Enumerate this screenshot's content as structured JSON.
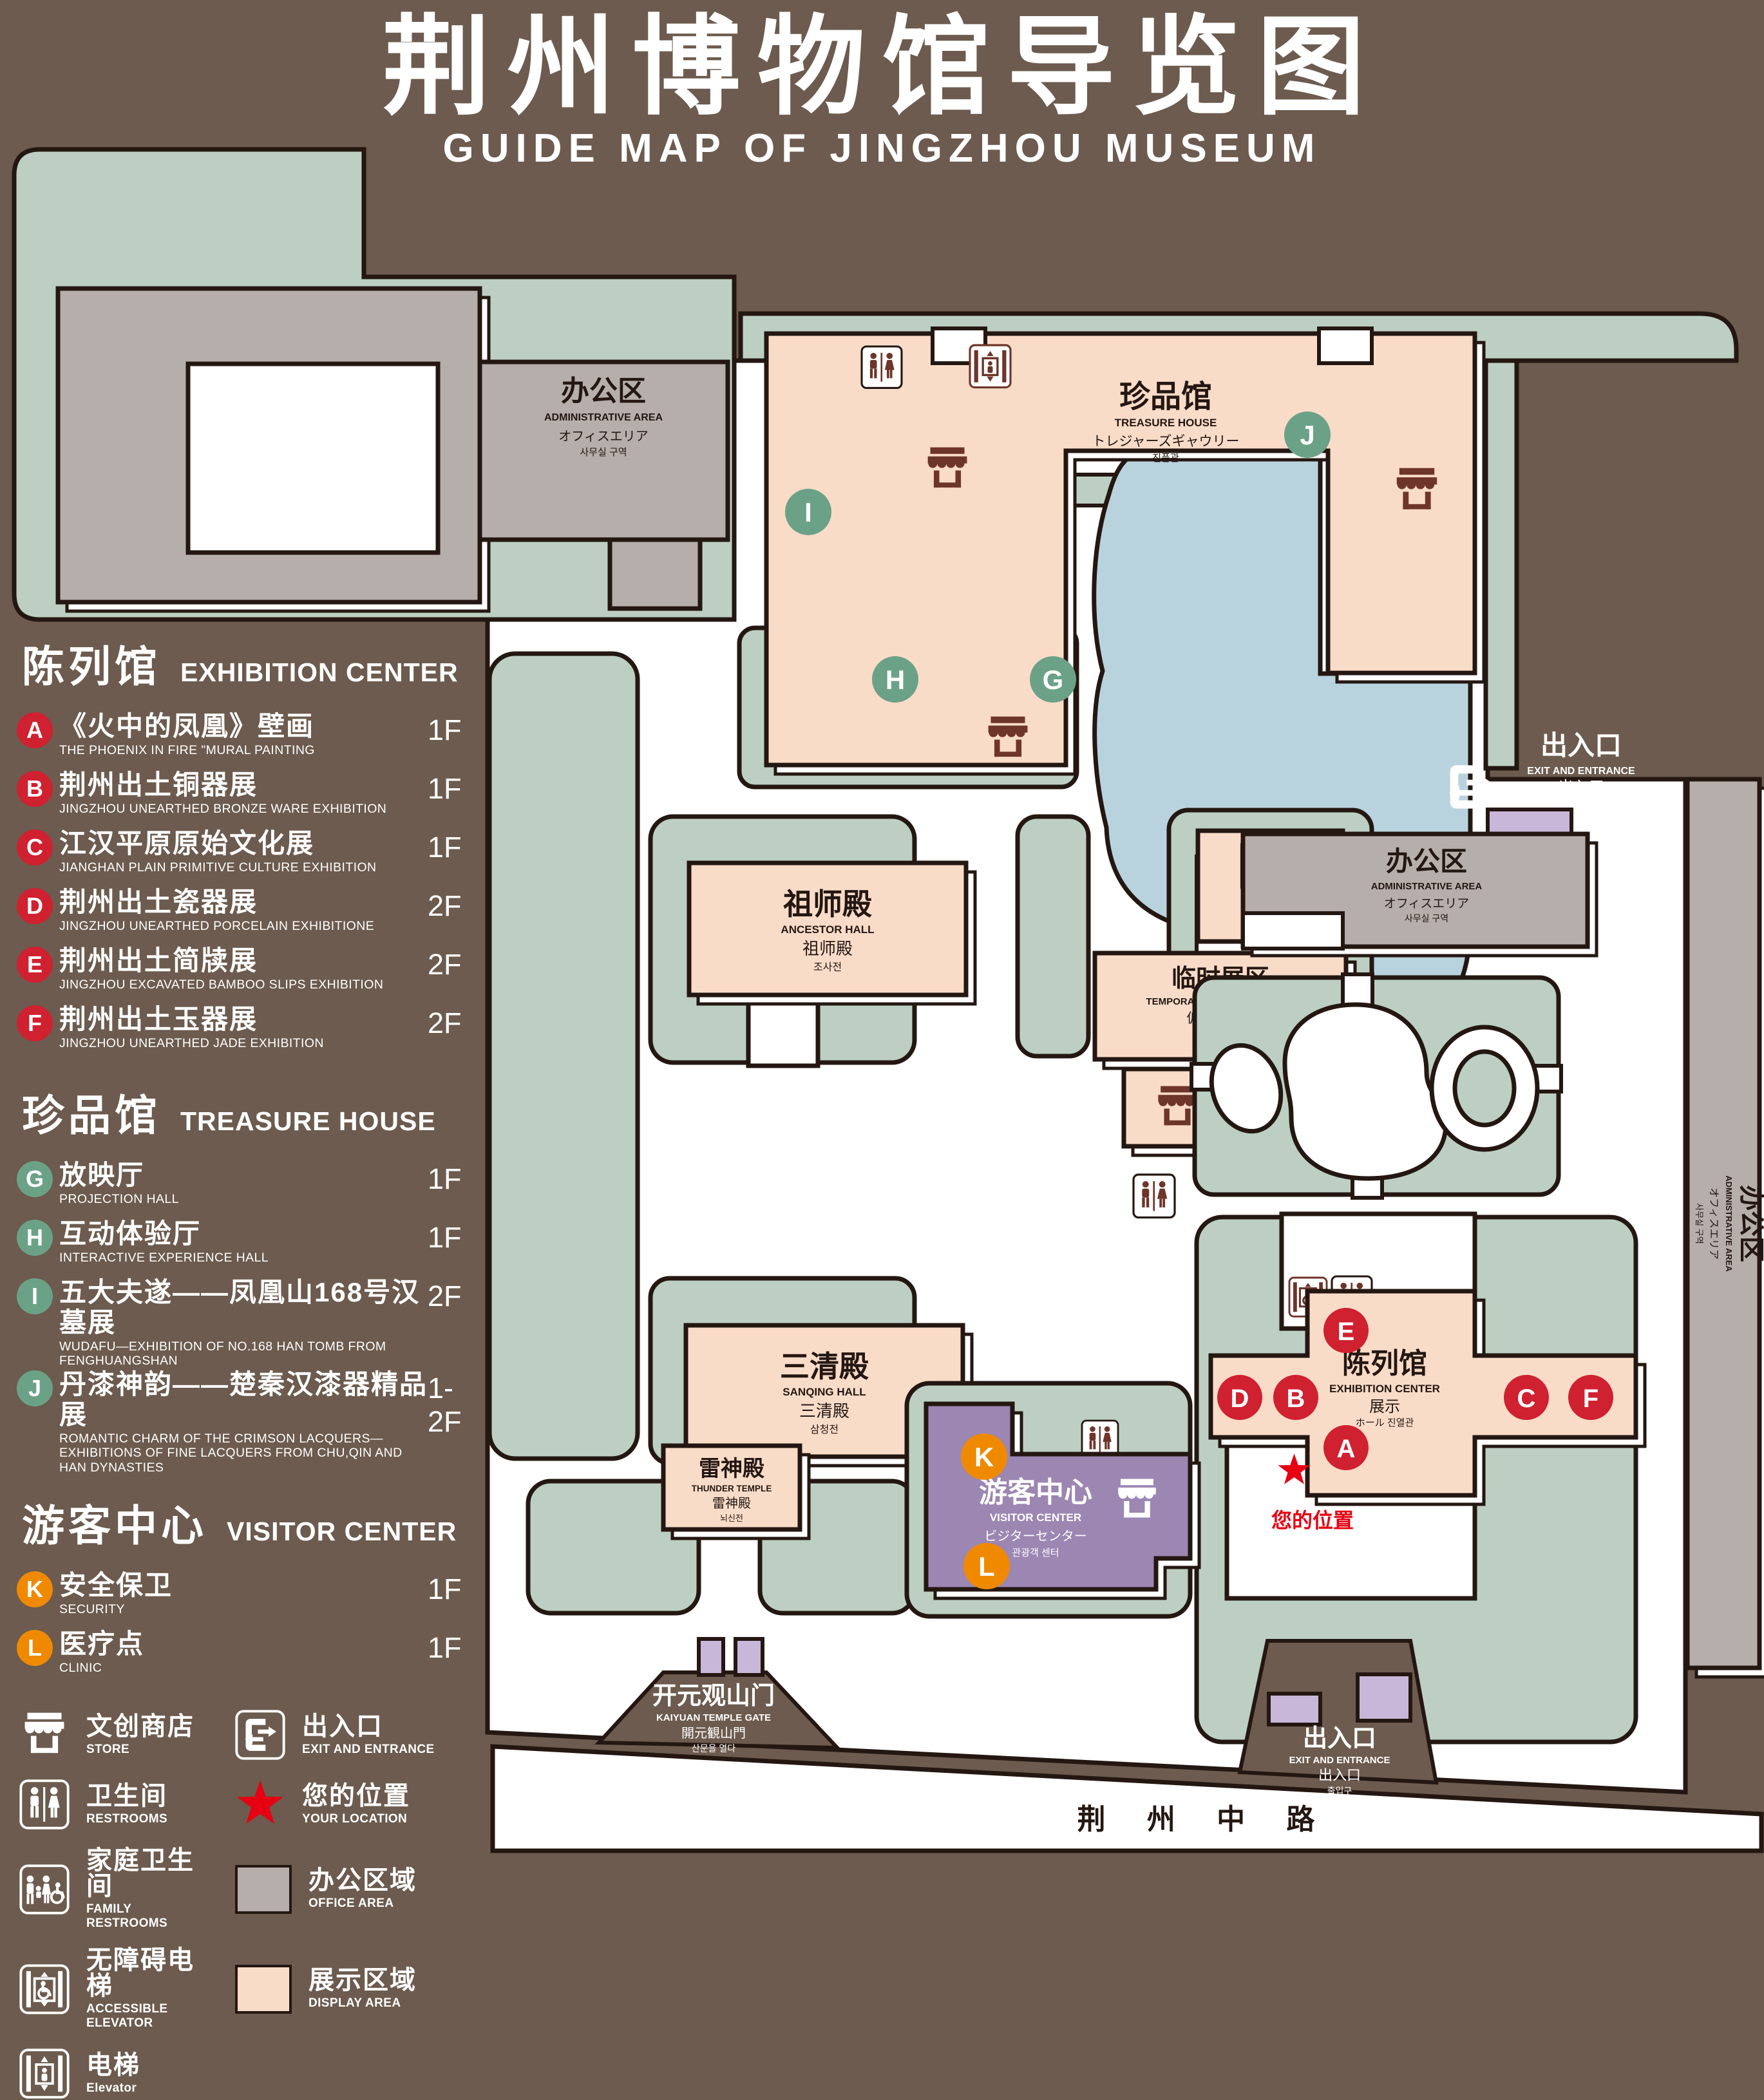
{
  "title": {
    "zh": "荆州博物馆导览图",
    "en": "GUIDE MAP OF JINGZHOU MUSEUM"
  },
  "colors": {
    "background": "#6c5b4e",
    "green": "#bccfc2",
    "display_pink": "#f9dcc8",
    "office_gray": "#b5aeaa",
    "lake_blue": "#b9d3de",
    "visitor_purple": "#9c86b2",
    "light_purple": "#c8b7d8",
    "outline": "#241712",
    "icon_maroon": "#6e352a",
    "badge_red": "#cf2130",
    "badge_green": "#6ba287",
    "badge_orange": "#ef8a00",
    "star_red": "#e60012"
  },
  "legend": {
    "sections": [
      {
        "zh": "陈列馆",
        "en": "EXHIBITION CENTER",
        "items": [
          {
            "letter": "A",
            "zh": "《火中的凤凰》壁画",
            "en": "THE PHOENIX IN FIRE \"MURAL PAINTING",
            "floor": "1F"
          },
          {
            "letter": "B",
            "zh": "荆州出土铜器展",
            "en": "JINGZHOU UNEARTHED BRONZE WARE EXHIBITION",
            "floor": "1F"
          },
          {
            "letter": "C",
            "zh": "江汉平原原始文化展",
            "en": "JIANGHAN PLAIN PRIMITIVE CULTURE EXHIBITION",
            "floor": "1F"
          },
          {
            "letter": "D",
            "zh": "荆州出土瓷器展",
            "en": "JINGZHOU UNEARTHED PORCELAIN EXHIBITIONE",
            "floor": "2F"
          },
          {
            "letter": "E",
            "zh": "荆州出土简牍展",
            "en": "JINGZHOU EXCAVATED BAMBOO SLIPS EXHIBITION",
            "floor": "2F"
          },
          {
            "letter": "F",
            "zh": "荆州出土玉器展",
            "en": "JINGZHOU UNEARTHED JADE EXHIBITION",
            "floor": "2F"
          }
        ]
      },
      {
        "zh": "珍品馆",
        "en": "TREASURE HOUSE",
        "items": [
          {
            "letter": "G",
            "zh": "放映厅",
            "en": "PROJECTION HALL",
            "floor": "1F"
          },
          {
            "letter": "H",
            "zh": "互动体验厅",
            "en": "INTERACTIVE EXPERIENCE HALL",
            "floor": "1F"
          },
          {
            "letter": "I",
            "zh": "五大夫遂——凤凰山168号汉墓展",
            "en": "WUDAFU—EXHIBITION OF NO.168 HAN TOMB FROM FENGHUANGSHAN",
            "floor": "2F"
          },
          {
            "letter": "J",
            "zh": "丹漆神韵——楚秦汉漆器精品展",
            "en": "ROMANTIC CHARM OF THE CRIMSON LACQUERS—EXHIBITIONS OF FINE LACQUERS FROM CHU,QIN AND HAN DYNASTIES",
            "floor": "1-2F"
          }
        ]
      },
      {
        "zh": "游客中心",
        "en": "VISITOR CENTER",
        "items": [
          {
            "letter": "K",
            "zh": "安全保卫",
            "en": "SECURITY",
            "floor": "1F"
          },
          {
            "letter": "L",
            "zh": "医疗点",
            "en": "CLINIC",
            "floor": "1F"
          }
        ]
      }
    ],
    "symbols": [
      {
        "icon": "store-icon",
        "zh": "文创商店",
        "en": "STORE"
      },
      {
        "icon": "exit-icon",
        "zh": "出入口",
        "en": "EXIT AND ENTRANCE"
      },
      {
        "icon": "restroom-icon",
        "zh": "卫生间",
        "en": "RESTROOMS"
      },
      {
        "icon": "location-star-icon",
        "zh": "您的位置",
        "en": "YOUR LOCATION"
      },
      {
        "icon": "family-restroom-icon",
        "zh": "家庭卫生间",
        "en": "FAMILY RESTROOMS"
      },
      {
        "icon": "office-swatch",
        "zh": "办公区域",
        "en": "OFFICE AREA"
      },
      {
        "icon": "accessible-elevator-icon",
        "zh": "无障碍电梯",
        "en": "ACCESSIBLE ELEVATOR"
      },
      {
        "icon": "display-swatch",
        "zh": "展示区域",
        "en": "DISPLAY AREA"
      },
      {
        "icon": "elevator-icon",
        "zh": "电梯",
        "en": "Elevator"
      }
    ]
  },
  "map": {
    "badges": {
      "A": "A",
      "B": "B",
      "C": "C",
      "D": "D",
      "E": "E",
      "F": "F",
      "G": "G",
      "H": "H",
      "I": "I",
      "J": "J",
      "K": "K",
      "L": "L"
    },
    "buildings": {
      "admin": {
        "zh": "办公区",
        "en": "ADMINISTRATIVE AREA",
        "l3": "オフィスエリア",
        "l4": "사무실 구역"
      },
      "treasure": {
        "zh": "珍品馆",
        "en": "TREASURE HOUSE",
        "l3": "トレジャーズギャウリー",
        "l4": "진품관"
      },
      "ancestor": {
        "zh": "祖师殿",
        "en": "ANCESTOR HALL",
        "l3": "祖师殿",
        "l4": "조사전"
      },
      "sanqing": {
        "zh": "三清殿",
        "en": "SANQING HALL",
        "l3": "三清殿",
        "l4": "삼청전"
      },
      "thunder": {
        "zh": "雷神殿",
        "en": "THUNDER TEMPLE",
        "l3": "雷神殿",
        "l4": "뇌신전"
      },
      "temporary": {
        "zh": "临时展区",
        "en": "TEMPORARY EXHIBITION AREA",
        "l3": "仮設展示区",
        "l4": "임시 전시실"
      },
      "exhibition": {
        "zh": "陈列馆",
        "en": "EXHIBITION CENTER",
        "l3": "展示",
        "l4": "ホール 진열관"
      },
      "visitor": {
        "zh": "游客中心",
        "en": "VISITOR CENTER",
        "l3": "ビジターセンター",
        "l4": "관광객 센터"
      },
      "exit": {
        "zh": "出入口",
        "en": "EXIT AND ENTRANCE",
        "l3": "出入口",
        "l4": "출입구"
      },
      "gate": {
        "zh": "开元观山门",
        "en": "KAIYUAN TEMPLE GATE",
        "l3": "開元観山門",
        "l4": "산문을 열다"
      },
      "road": {
        "zh": "荆 州 中 路"
      },
      "your_location": {
        "zh": "您的位置"
      }
    }
  }
}
